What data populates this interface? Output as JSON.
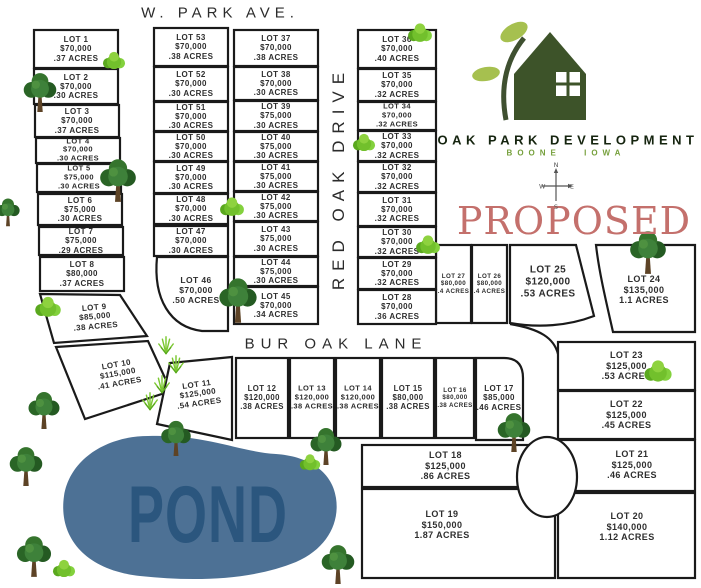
{
  "streets": {
    "w_park_ave": "W. PARK AVE.",
    "red_oak_drive": "RED OAK DRIVE",
    "bur_oak_lane": "BUR OAK LANE"
  },
  "pond": {
    "label": "POND"
  },
  "proposed_label": "PROPOSED",
  "logo": {
    "name": "OAK PARK DEVELOPMENT",
    "location": "BOONE IOWA"
  },
  "compass": {
    "n": "N",
    "e": "E",
    "s": "S",
    "w": "W"
  },
  "colors": {
    "lot_line": "#1a1a1a",
    "pond_fill": "#4d7195",
    "pond_text": "#2b567e",
    "proposed_red": "#c4706c",
    "logo_green": "#3d5329",
    "leaf_green": "#a6c04f",
    "boone_green": "#76a03c"
  },
  "lots": [
    {
      "num": 1,
      "name": "LOT 1",
      "price": "$70,000",
      "acres": ".37 ACRES",
      "fs": 8,
      "shape": {
        "type": "rect",
        "x": 34,
        "y": 30,
        "w": 84,
        "h": 38
      }
    },
    {
      "num": 2,
      "name": "LOT 2",
      "price": "$70,000",
      "acres": ".30 ACRES",
      "fs": 8,
      "shape": {
        "type": "rect",
        "x": 34,
        "y": 69,
        "w": 84,
        "h": 35
      }
    },
    {
      "num": 3,
      "name": "LOT 3",
      "price": "$70,000",
      "acres": ".37 ACRES",
      "fs": 8,
      "shape": {
        "type": "rect",
        "x": 35,
        "y": 105,
        "w": 84,
        "h": 32
      }
    },
    {
      "num": 4,
      "name": "LOT 4",
      "price": "$70,000",
      "acres": ".30 ACRES",
      "fs": 7.5,
      "shape": {
        "type": "rect",
        "x": 36,
        "y": 138,
        "w": 84,
        "h": 25
      }
    },
    {
      "num": 5,
      "name": "LOT 5",
      "price": "$75,000",
      "acres": ".30 ACRES",
      "fs": 7.5,
      "shape": {
        "type": "rect",
        "x": 37,
        "y": 164,
        "w": 84,
        "h": 28
      }
    },
    {
      "num": 6,
      "name": "LOT 6",
      "price": "$75,000",
      "acres": ".30 ACRES",
      "fs": 8,
      "shape": {
        "type": "rect",
        "x": 38,
        "y": 194,
        "w": 84,
        "h": 31
      }
    },
    {
      "num": 7,
      "name": "LOT 7",
      "price": "$75,000",
      "acres": ".29 ACRES",
      "fs": 8,
      "shape": {
        "type": "rect",
        "x": 39,
        "y": 227,
        "w": 84,
        "h": 28
      }
    },
    {
      "num": 8,
      "name": "LOT 8",
      "price": "$80,000",
      "acres": ".37 ACRES",
      "fs": 8,
      "shape": {
        "type": "rect",
        "x": 40,
        "y": 257,
        "w": 84,
        "h": 34
      }
    },
    {
      "num": 9,
      "name": "LOT 9",
      "price": "$85,000",
      "acres": ".38 ACRES",
      "fs": 8,
      "shape": {
        "type": "poly",
        "points": "40,294 120,295 147,336 54,343"
      },
      "label": {
        "x": 95,
        "y": 317,
        "rot": -5
      }
    },
    {
      "num": 10,
      "name": "LOT 10",
      "price": "$115,000",
      "acres": ".41 ACRES",
      "fs": 8,
      "shape": {
        "type": "poly",
        "points": "56,347 148,341 171,391 85,419"
      },
      "label": {
        "x": 118,
        "y": 374,
        "rot": -10
      }
    },
    {
      "num": 11,
      "name": "LOT 11",
      "price": "$125,000",
      "acres": ".54 ACRES",
      "fs": 8,
      "shape": {
        "type": "poly",
        "points": "170,363 232,357 232,440 157,424"
      },
      "label": {
        "x": 198,
        "y": 394,
        "rot": -8
      }
    },
    {
      "num": 12,
      "name": "LOT 12",
      "price": "$120,000",
      "acres": ".38 ACRES",
      "fs": 7.8,
      "shape": {
        "type": "rect",
        "x": 236,
        "y": 358,
        "w": 52,
        "h": 80
      }
    },
    {
      "num": 13,
      "name": "LOT 13",
      "price": "$120,000",
      "acres": ".38 ACRES",
      "fs": 7.5,
      "shape": {
        "type": "rect",
        "x": 290,
        "y": 358,
        "w": 44,
        "h": 80
      }
    },
    {
      "num": 14,
      "name": "LOT 14",
      "price": "$120,000",
      "acres": ".38 ACRES",
      "fs": 7.5,
      "shape": {
        "type": "rect",
        "x": 336,
        "y": 358,
        "w": 44,
        "h": 80
      }
    },
    {
      "num": 15,
      "name": "LOT 15",
      "price": "$80,000",
      "acres": ".38 ACRES",
      "fs": 7.8,
      "shape": {
        "type": "rect",
        "x": 382,
        "y": 358,
        "w": 52,
        "h": 80
      }
    },
    {
      "num": 16,
      "name": "LOT 16",
      "price": "$80,000",
      "acres": ".38 ACRES",
      "fs": 6.2,
      "shape": {
        "type": "rect",
        "x": 436,
        "y": 358,
        "w": 38,
        "h": 80
      }
    },
    {
      "num": 17,
      "name": "LOT 17",
      "price": "$85,000",
      "acres": ".46 ACRES",
      "fs": 8,
      "shape": {
        "type": "path",
        "d": "M476,358 L504,358 C517,358 523,365 523,378 L523,440 L476,440 Z"
      },
      "label": {
        "x": 499,
        "y": 398
      }
    },
    {
      "num": 18,
      "name": "LOT 18",
      "price": "$125,000",
      "acres": ".86 ACRES",
      "fs": 9,
      "shape": {
        "type": "rect",
        "x": 362,
        "y": 445,
        "w": 167,
        "h": 42
      }
    },
    {
      "num": 19,
      "name": "LOT 19",
      "price": "$150,000",
      "acres": "1.87 ACRES",
      "fs": 9,
      "shape": {
        "type": "rect",
        "x": 362,
        "y": 489,
        "w": 193,
        "h": 89
      },
      "label": {
        "x": 442,
        "y": 525
      }
    },
    {
      "num": 20,
      "name": "LOT 20",
      "price": "$140,000",
      "acres": "1.12 ACRES",
      "fs": 9,
      "shape": {
        "type": "rect",
        "x": 558,
        "y": 493,
        "w": 137,
        "h": 85
      },
      "label": {
        "x": 627,
        "y": 527
      }
    },
    {
      "num": 21,
      "name": "LOT 21",
      "price": "$125,000",
      "acres": ".46 ACRES",
      "fs": 9,
      "shape": {
        "type": "rect",
        "x": 560,
        "y": 440,
        "w": 135,
        "h": 51
      },
      "label": {
        "x": 632,
        "y": 465
      }
    },
    {
      "num": 22,
      "name": "LOT 22",
      "price": "$125,000",
      "acres": ".45 ACRES",
      "fs": 9,
      "shape": {
        "type": "rect",
        "x": 558,
        "y": 391,
        "w": 137,
        "h": 48
      }
    },
    {
      "num": 23,
      "name": "LOT 23",
      "price": "$125,000",
      "acres": ".53 ACRES",
      "fs": 9,
      "shape": {
        "type": "rect",
        "x": 558,
        "y": 342,
        "w": 137,
        "h": 48
      }
    },
    {
      "num": 24,
      "name": "LOT 24",
      "price": "$135,000",
      "acres": "1.1 ACRES",
      "fs": 9,
      "shape": {
        "type": "path",
        "d": "M596,245 L695,245 L695,332 L613,332 C606,301 599,272 596,245 Z"
      },
      "label": {
        "x": 644,
        "y": 290
      }
    },
    {
      "num": 25,
      "name": "LOT 25",
      "price": "$120,000",
      "acres": ".53 ACRES",
      "fs": 10,
      "shape": {
        "type": "path",
        "d": "M510,245 L576,245 L594,316 C568,326 538,328 510,323 Z"
      },
      "label": {
        "x": 548,
        "y": 282
      }
    },
    {
      "num": 26,
      "name": "LOT 26",
      "price": "$80,000",
      "acres": ".4 ACRES",
      "fs": 6.2,
      "shape": {
        "type": "rect",
        "x": 472,
        "y": 245,
        "w": 35,
        "h": 78
      }
    },
    {
      "num": 27,
      "name": "LOT 27",
      "price": "$80,000",
      "acres": ".4 ACRES",
      "fs": 6.2,
      "shape": {
        "type": "rect",
        "x": 436,
        "y": 245,
        "w": 35,
        "h": 78
      }
    },
    {
      "num": 28,
      "name": "LOT 28",
      "price": "$70,000",
      "acres": ".36 ACRES",
      "fs": 8,
      "shape": {
        "type": "rect",
        "x": 358,
        "y": 290,
        "w": 78,
        "h": 34
      }
    },
    {
      "num": 29,
      "name": "LOT 29",
      "price": "$70,000",
      "acres": ".32 ACRES",
      "fs": 8,
      "shape": {
        "type": "rect",
        "x": 358,
        "y": 258,
        "w": 78,
        "h": 31
      }
    },
    {
      "num": 30,
      "name": "LOT 30",
      "price": "$70,000",
      "acres": ".32 ACRES",
      "fs": 8,
      "shape": {
        "type": "rect",
        "x": 358,
        "y": 227,
        "w": 78,
        "h": 30
      }
    },
    {
      "num": 31,
      "name": "LOT 31",
      "price": "$70,000",
      "acres": ".32 ACRES",
      "fs": 8,
      "shape": {
        "type": "rect",
        "x": 358,
        "y": 193,
        "w": 78,
        "h": 33
      }
    },
    {
      "num": 32,
      "name": "LOT 32",
      "price": "$70,000",
      "acres": ".32 ACRES",
      "fs": 8,
      "shape": {
        "type": "rect",
        "x": 358,
        "y": 162,
        "w": 78,
        "h": 30
      }
    },
    {
      "num": 33,
      "name": "LOT 33",
      "price": "$70,000",
      "acres": ".32 ACRES",
      "fs": 8,
      "shape": {
        "type": "rect",
        "x": 358,
        "y": 131,
        "w": 78,
        "h": 30
      }
    },
    {
      "num": 34,
      "name": "LOT 34",
      "price": "$70,000",
      "acres": ".32 ACRES",
      "fs": 7.5,
      "shape": {
        "type": "rect",
        "x": 358,
        "y": 102,
        "w": 78,
        "h": 28
      }
    },
    {
      "num": 35,
      "name": "LOT 35",
      "price": "$70,000",
      "acres": ".32 ACRES",
      "fs": 8,
      "shape": {
        "type": "rect",
        "x": 358,
        "y": 69,
        "w": 78,
        "h": 32
      }
    },
    {
      "num": 36,
      "name": "LOT 36",
      "price": "$70,000",
      "acres": ".40 ACRES",
      "fs": 8,
      "shape": {
        "type": "rect",
        "x": 358,
        "y": 30,
        "w": 78,
        "h": 38
      }
    },
    {
      "num": 37,
      "name": "LOT 37",
      "price": "$70,000",
      "acres": ".38 ACRES",
      "fs": 8,
      "shape": {
        "type": "rect",
        "x": 234,
        "y": 30,
        "w": 84,
        "h": 36
      }
    },
    {
      "num": 38,
      "name": "LOT 38",
      "price": "$70,000",
      "acres": ".30 ACRES",
      "fs": 8,
      "shape": {
        "type": "rect",
        "x": 234,
        "y": 67,
        "w": 84,
        "h": 33
      }
    },
    {
      "num": 39,
      "name": "LOT 39",
      "price": "$75,000",
      "acres": ".30 ACRES",
      "fs": 8,
      "shape": {
        "type": "rect",
        "x": 234,
        "y": 101,
        "w": 84,
        "h": 30
      }
    },
    {
      "num": 40,
      "name": "LOT 40",
      "price": "$75,000",
      "acres": ".30 ACRES",
      "fs": 8,
      "shape": {
        "type": "rect",
        "x": 234,
        "y": 132,
        "w": 84,
        "h": 29
      }
    },
    {
      "num": 41,
      "name": "LOT 41",
      "price": "$75,000",
      "acres": ".30 ACRES",
      "fs": 8,
      "shape": {
        "type": "rect",
        "x": 234,
        "y": 162,
        "w": 84,
        "h": 29
      }
    },
    {
      "num": 42,
      "name": "LOT 42",
      "price": "$75,000",
      "acres": ".30 ACRES",
      "fs": 8,
      "shape": {
        "type": "rect",
        "x": 234,
        "y": 192,
        "w": 84,
        "h": 29
      }
    },
    {
      "num": 43,
      "name": "LOT 43",
      "price": "$75,000",
      "acres": ".30 ACRES",
      "fs": 8,
      "shape": {
        "type": "rect",
        "x": 234,
        "y": 222,
        "w": 84,
        "h": 34
      }
    },
    {
      "num": 44,
      "name": "LOT 44",
      "price": "$75,000",
      "acres": ".30 ACRES",
      "fs": 8,
      "shape": {
        "type": "rect",
        "x": 234,
        "y": 257,
        "w": 84,
        "h": 29
      }
    },
    {
      "num": 45,
      "name": "LOT 45",
      "price": "$70,000",
      "acres": ".34 ACRES",
      "fs": 8,
      "shape": {
        "type": "rect",
        "x": 234,
        "y": 287,
        "w": 84,
        "h": 37
      }
    },
    {
      "num": 46,
      "name": "LOT 46",
      "price": "$70,000",
      "acres": ".50 ACRES",
      "fs": 8.5,
      "shape": {
        "type": "path",
        "d": "M157,257 L228,257 L228,331 L202,331 C170,327 153,299 157,257 Z"
      },
      "label": {
        "x": 196,
        "y": 290
      }
    },
    {
      "num": 47,
      "name": "LOT 47",
      "price": "$70,000",
      "acres": ".30 ACRES",
      "fs": 8,
      "shape": {
        "type": "rect",
        "x": 154,
        "y": 226,
        "w": 74,
        "h": 30
      }
    },
    {
      "num": 48,
      "name": "LOT 48",
      "price": "$70,000",
      "acres": ".30 ACRES",
      "fs": 8,
      "shape": {
        "type": "rect",
        "x": 154,
        "y": 194,
        "w": 74,
        "h": 30
      }
    },
    {
      "num": 49,
      "name": "LOT 49",
      "price": "$70,000",
      "acres": ".30 ACRES",
      "fs": 8,
      "shape": {
        "type": "rect",
        "x": 154,
        "y": 162,
        "w": 74,
        "h": 31
      }
    },
    {
      "num": 50,
      "name": "LOT 50",
      "price": "$70,000",
      "acres": ".30 ACRES",
      "fs": 8,
      "shape": {
        "type": "rect",
        "x": 154,
        "y": 132,
        "w": 74,
        "h": 29
      }
    },
    {
      "num": 51,
      "name": "LOT 51",
      "price": "$70,000",
      "acres": ".30 ACRES",
      "fs": 8,
      "shape": {
        "type": "rect",
        "x": 154,
        "y": 102,
        "w": 74,
        "h": 29
      }
    },
    {
      "num": 52,
      "name": "LOT 52",
      "price": "$70,000",
      "acres": ".30 ACRES",
      "fs": 8,
      "shape": {
        "type": "rect",
        "x": 154,
        "y": 67,
        "w": 74,
        "h": 34
      }
    },
    {
      "num": 53,
      "name": "LOT 53",
      "price": "$70,000",
      "acres": ".38 ACRES",
      "fs": 8,
      "shape": {
        "type": "rect",
        "x": 154,
        "y": 28,
        "w": 74,
        "h": 38
      }
    }
  ],
  "decorations": [
    {
      "icon": "bush-icon",
      "x": 114,
      "y": 58,
      "s": 26
    },
    {
      "icon": "tree-icon",
      "x": 40,
      "y": 92,
      "s": 42
    },
    {
      "icon": "tree-icon",
      "x": 118,
      "y": 180,
      "s": 46
    },
    {
      "icon": "tree-icon",
      "x": 8,
      "y": 212,
      "s": 30
    },
    {
      "icon": "bush-icon",
      "x": 232,
      "y": 204,
      "s": 28
    },
    {
      "icon": "tree-icon",
      "x": 238,
      "y": 300,
      "s": 48
    },
    {
      "icon": "bush-icon",
      "x": 420,
      "y": 30,
      "s": 28
    },
    {
      "icon": "bush-icon",
      "x": 364,
      "y": 140,
      "s": 26
    },
    {
      "icon": "bush-icon",
      "x": 428,
      "y": 242,
      "s": 28
    },
    {
      "icon": "tree-icon",
      "x": 648,
      "y": 252,
      "s": 46
    },
    {
      "icon": "bush-icon",
      "x": 658,
      "y": 368,
      "s": 32
    },
    {
      "icon": "bush-icon",
      "x": 48,
      "y": 304,
      "s": 30
    },
    {
      "icon": "grass-icon",
      "x": 166,
      "y": 344,
      "s": 24
    },
    {
      "icon": "grass-icon",
      "x": 176,
      "y": 363,
      "s": 24
    },
    {
      "icon": "grass-icon",
      "x": 162,
      "y": 383,
      "s": 24
    },
    {
      "icon": "grass-icon",
      "x": 150,
      "y": 400,
      "s": 24
    },
    {
      "icon": "tree-icon",
      "x": 44,
      "y": 410,
      "s": 40
    },
    {
      "icon": "tree-icon",
      "x": 26,
      "y": 466,
      "s": 42
    },
    {
      "icon": "tree-icon",
      "x": 34,
      "y": 556,
      "s": 44
    },
    {
      "icon": "bush-icon",
      "x": 64,
      "y": 566,
      "s": 26
    },
    {
      "icon": "tree-icon",
      "x": 176,
      "y": 438,
      "s": 38
    },
    {
      "icon": "tree-icon",
      "x": 326,
      "y": 446,
      "s": 40
    },
    {
      "icon": "bush-icon",
      "x": 310,
      "y": 460,
      "s": 24
    },
    {
      "icon": "tree-icon",
      "x": 338,
      "y": 564,
      "s": 42
    },
    {
      "icon": "tree-icon",
      "x": 514,
      "y": 432,
      "s": 42
    }
  ]
}
